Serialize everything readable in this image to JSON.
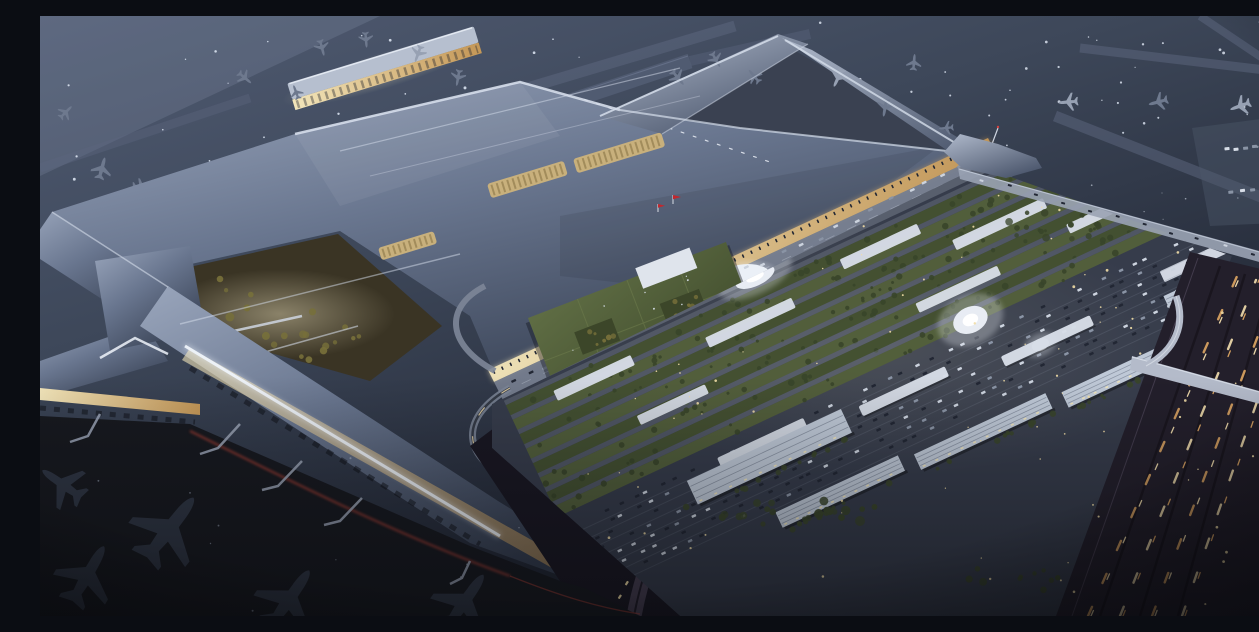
{
  "meta": {
    "title": "Aerial dusk rendering of a large airport terminal campus",
    "type": "architectural-rendering",
    "time_of_day": "dusk"
  },
  "scene": {
    "description": "Bird's-eye night view: silver X-shaped terminal with warm skylights and lit curbside, piers with parked aircraft, landside blocks with green roofs, glowing circular plazas, car parks, parking garages, elevated viaduct and a highway with light trails.",
    "landmarks": [
      "main-terminal-roof",
      "satellite-concourse",
      "boarding-piers",
      "parked-aircraft",
      "garden-courtyard",
      "curbside-road",
      "landside-green-roof-blocks",
      "circular-plazas",
      "surface-parking",
      "parking-garages",
      "elevated-viaduct",
      "highway-light-trails"
    ]
  },
  "palette": {
    "bg_top": "#505b72",
    "bg_mid": "#3d4759",
    "bg_deep": "#12151f",
    "haze": "#a9b7cf",
    "taxiway": "#5d6780",
    "taxiway_edge": "#78839d",
    "apron_interarm": "#3a4151",
    "apron_dark": "#17191f",
    "roof_light": "#9aa6bc",
    "roof_mid": "#69768f",
    "roof_dark": "#343d4f",
    "roof_highlight": "#d6deeb",
    "roof_edge_bright": "#eef3fa",
    "satellite_roof": "#b6bfcf",
    "skylight": "#c8b07c",
    "skylight_slat": "#7e6a3c",
    "facade_warm": "#f2e5ba",
    "facade_deep": "#c49757",
    "flag_red": "#c2272d",
    "garden_base": "#3a3424",
    "tree_warm": "#77703a",
    "tree_green": "#39452a",
    "plane_air": "#6e798e",
    "plane_air_light": "#97a1b3",
    "plane_dark": "#2f3644",
    "curb_road": "#7a8292",
    "road_mark": "#cfd6e2",
    "plaza_white": "#ebf0f7",
    "green_roof": "#53603a",
    "green_roof_alt": "#45512f",
    "lane_grey": "#79818f",
    "canopy_white": "#d7dde7",
    "garage_white": "#bfc9d7",
    "garage_line": "#808a9b",
    "parking_base": "#363c4b",
    "car_light": "#ccd3de",
    "car_mid": "#8a94a5",
    "car_dark": "#222734",
    "office_facade": "#ccd3de",
    "ramp_grey": "#7d8698",
    "road_dark": "#191722",
    "front_road": "#473f52",
    "highway_base": "#231f2b",
    "lane_line": "#161219",
    "guard": "#584f63",
    "trail_amber": "#dfa763",
    "trail_bright": "#f4dfae",
    "overpass": "#b4bbca",
    "viaduct": "#9aa3b4",
    "light_dot": "#e3ebf8",
    "warm_dot": "#f1dda6",
    "cool_dot": "#b9c6da",
    "red_trail": "#c04437",
    "glow_warm": "#f7ecc6",
    "glow_white": "#eff4fb"
  },
  "procedural": {
    "seed": 987231,
    "dot_fields": [
      {
        "target": "dots-airfield-left",
        "x": 6,
        "y": 6,
        "w": 700,
        "h": 250,
        "count": 72,
        "color": "light_dot",
        "rmin": 0.6,
        "rmax": 1.6,
        "opacity": 0.85
      },
      {
        "target": "dots-airfield-right",
        "x": 700,
        "y": 4,
        "w": 552,
        "h": 150,
        "count": 50,
        "color": "light_dot",
        "rmin": 0.6,
        "rmax": 1.5,
        "opacity": 0.8
      },
      {
        "target": "dots-midfield",
        "x": 945,
        "y": 150,
        "w": 300,
        "h": 85,
        "count": 14,
        "color": "light_dot",
        "rmin": 0.5,
        "rmax": 1.1,
        "opacity": 0.55
      },
      {
        "target": "dots-complex",
        "x": 470,
        "y": 165,
        "w": 760,
        "h": 415,
        "count": 95,
        "color": "warm_dot",
        "rmin": 0.6,
        "rmax": 1.4,
        "opacity": 0.9
      },
      {
        "target": "dots-apron-sw",
        "x": 0,
        "y": 410,
        "w": 540,
        "h": 185,
        "count": 10,
        "color": "cool_dot",
        "rmin": 0.5,
        "rmax": 1.1,
        "opacity": 0.5
      },
      {
        "target": "dots-highway",
        "x": 1015,
        "y": 250,
        "w": 240,
        "h": 345,
        "count": 26,
        "color": "warm_dot",
        "rmin": 0.7,
        "rmax": 1.5,
        "opacity": 0.9
      },
      {
        "target": "dots-office-roof",
        "x": 4,
        "y": 4,
        "w": 204,
        "h": 84,
        "count": 14,
        "color": "light_dot",
        "rmin": 0.5,
        "rmax": 1.0,
        "opacity": 0.85
      }
    ],
    "dash_lines": [
      {
        "target": "curb-cars",
        "x1": 462,
        "y1": 372,
        "x2": 932,
        "y2": 146,
        "count": 26,
        "len": 5,
        "thick": 2.4,
        "jitter": 4,
        "colors": [
          "car_light",
          "car_dark",
          "car_mid"
        ]
      },
      {
        "target": "facade-columns",
        "x1": 450,
        "y1": 358,
        "x2": 948,
        "y2": 126,
        "count": 60,
        "len": 1.6,
        "thick": 3.6,
        "jitter": 0,
        "colors": [
          "car_dark"
        ]
      },
      {
        "target": "taxilane-dashes",
        "x1": 540,
        "y1": 82,
        "x2": 733,
        "y2": 147,
        "count": 16,
        "len": 4,
        "thick": 1.2,
        "jitter": 0,
        "colors": [
          "canopy_white"
        ]
      },
      {
        "target": "front-road-cars",
        "x1": 662,
        "y1": 448,
        "x2": 572,
        "y2": 588,
        "count": 9,
        "len": 4.5,
        "thick": 2.2,
        "jitter": 3,
        "colors": [
          "car_light",
          "warm_dot"
        ]
      },
      {
        "target": "viaduct-cars",
        "x1": 930,
        "y1": 160,
        "x2": 1252,
        "y2": 250,
        "count": 12,
        "len": 4,
        "thick": 2,
        "jitter": 2,
        "colors": [
          "car_light",
          "car_dark"
        ]
      },
      {
        "target": "remote-stands",
        "x1": 1182,
        "y1": 134,
        "x2": 1248,
        "y2": 127,
        "count": 7,
        "len": 5,
        "thick": 3,
        "jitter": 1,
        "colors": [
          "canopy_white",
          "car_mid"
        ]
      },
      {
        "target": "remote-stands",
        "x1": 1186,
        "y1": 176,
        "x2": 1250,
        "y2": 169,
        "count": 6,
        "len": 5,
        "thick": 3,
        "jitter": 1,
        "colors": [
          "canopy_white",
          "car_mid"
        ]
      }
    ],
    "trails": [
      {
        "target": "highway-trails",
        "paths": [
          [
            1048,
            600,
            1198,
            258
          ],
          [
            1080,
            600,
            1216,
            264
          ],
          [
            1112,
            600,
            1236,
            272
          ],
          [
            1142,
            600,
            1254,
            280
          ]
        ],
        "colors": [
          "trail_amber",
          "trail_bright"
        ],
        "dash": "10 26",
        "w": 2.4
      }
    ],
    "tree_clusters": [
      {
        "target": "trees-courtyard",
        "cx": 155,
        "cy": 282,
        "rx": 58,
        "ry": 26,
        "count": 16,
        "color": "tree_warm",
        "rmin": 2,
        "rmax": 4.5
      },
      {
        "target": "trees-courtyard2",
        "cx": 268,
        "cy": 320,
        "rx": 55,
        "ry": 26,
        "count": 14,
        "color": "tree_warm",
        "rmin": 2,
        "rmax": 4
      },
      {
        "target": "trees-office",
        "cx": 520,
        "cy": 432,
        "rx": 75,
        "ry": 22,
        "count": 18,
        "color": "tree_green",
        "rmin": 2.5,
        "rmax": 5
      },
      {
        "target": "trees-office2",
        "cx": 700,
        "cy": 332,
        "rx": 48,
        "ry": 16,
        "count": 12,
        "color": "tree_green",
        "rmin": 2,
        "rmax": 4
      },
      {
        "target": "trees-garage-row",
        "cx": 745,
        "cy": 497,
        "rx": 110,
        "ry": 14,
        "count": 22,
        "color": "tree_green",
        "rmin": 2.5,
        "rmax": 5
      },
      {
        "target": "trees-highway-gap",
        "cx": 980,
        "cy": 560,
        "rx": 60,
        "ry": 18,
        "count": 10,
        "color": "tree_green",
        "rmin": 2,
        "rmax": 4
      },
      {
        "target": "trees-ne",
        "cx": 1002,
        "cy": 208,
        "rx": 65,
        "ry": 18,
        "count": 12,
        "color": "tree_green",
        "rmin": 2,
        "rmax": 4
      },
      {
        "target": "office-court",
        "cx": 60,
        "cy": 42,
        "rx": 20,
        "ry": 12,
        "count": 6,
        "color": "tree_warm",
        "rmin": 1.5,
        "rmax": 3
      },
      {
        "target": "office-court",
        "cx": 150,
        "cy": 46,
        "rx": 20,
        "ry": 12,
        "count": 6,
        "color": "tree_warm",
        "rmin": 1.5,
        "rmax": 3
      }
    ],
    "complex": {
      "green_band": {
        "x0": 6,
        "x1": 716,
        "y0": 8,
        "rows": 8,
        "row_h": 11,
        "lane_h": 5,
        "trees_per_row": 26
      },
      "parking": {
        "x0": 12,
        "x1": 705,
        "y0": 148,
        "rows": 7,
        "row_h": 10.5,
        "cars_per_row": 44
      },
      "white_slabs": [
        [
          55,
          20,
          85,
          11
        ],
        [
          215,
          36,
          95,
          11
        ],
        [
          370,
          22,
          85,
          11
        ],
        [
          480,
          52,
          100,
          11
        ],
        [
          610,
          34,
          85,
          11
        ],
        [
          120,
          78,
          75,
          10
        ],
        [
          420,
          94,
          90,
          10
        ],
        [
          590,
          86,
          75,
          10
        ],
        [
          655,
          168,
          85,
          12
        ]
      ],
      "plazas": [
        [
          286,
          2,
          21,
          9
        ],
        [
          463,
          132,
          18,
          13
        ],
        [
          516,
          184,
          9,
          6
        ]
      ],
      "canopies": [
        [
          175,
          150,
          95,
          11
        ],
        [
          325,
          163,
          95,
          11
        ],
        [
          475,
          178,
          98,
          11
        ]
      ],
      "garages": [
        [
          138,
          158,
          170,
          26
        ],
        [
          205,
          224,
          135,
          17
        ],
        [
          355,
          230,
          145,
          17
        ],
        [
          515,
          236,
          135,
          17
        ],
        [
          648,
          192,
          105,
          16
        ]
      ]
    }
  }
}
